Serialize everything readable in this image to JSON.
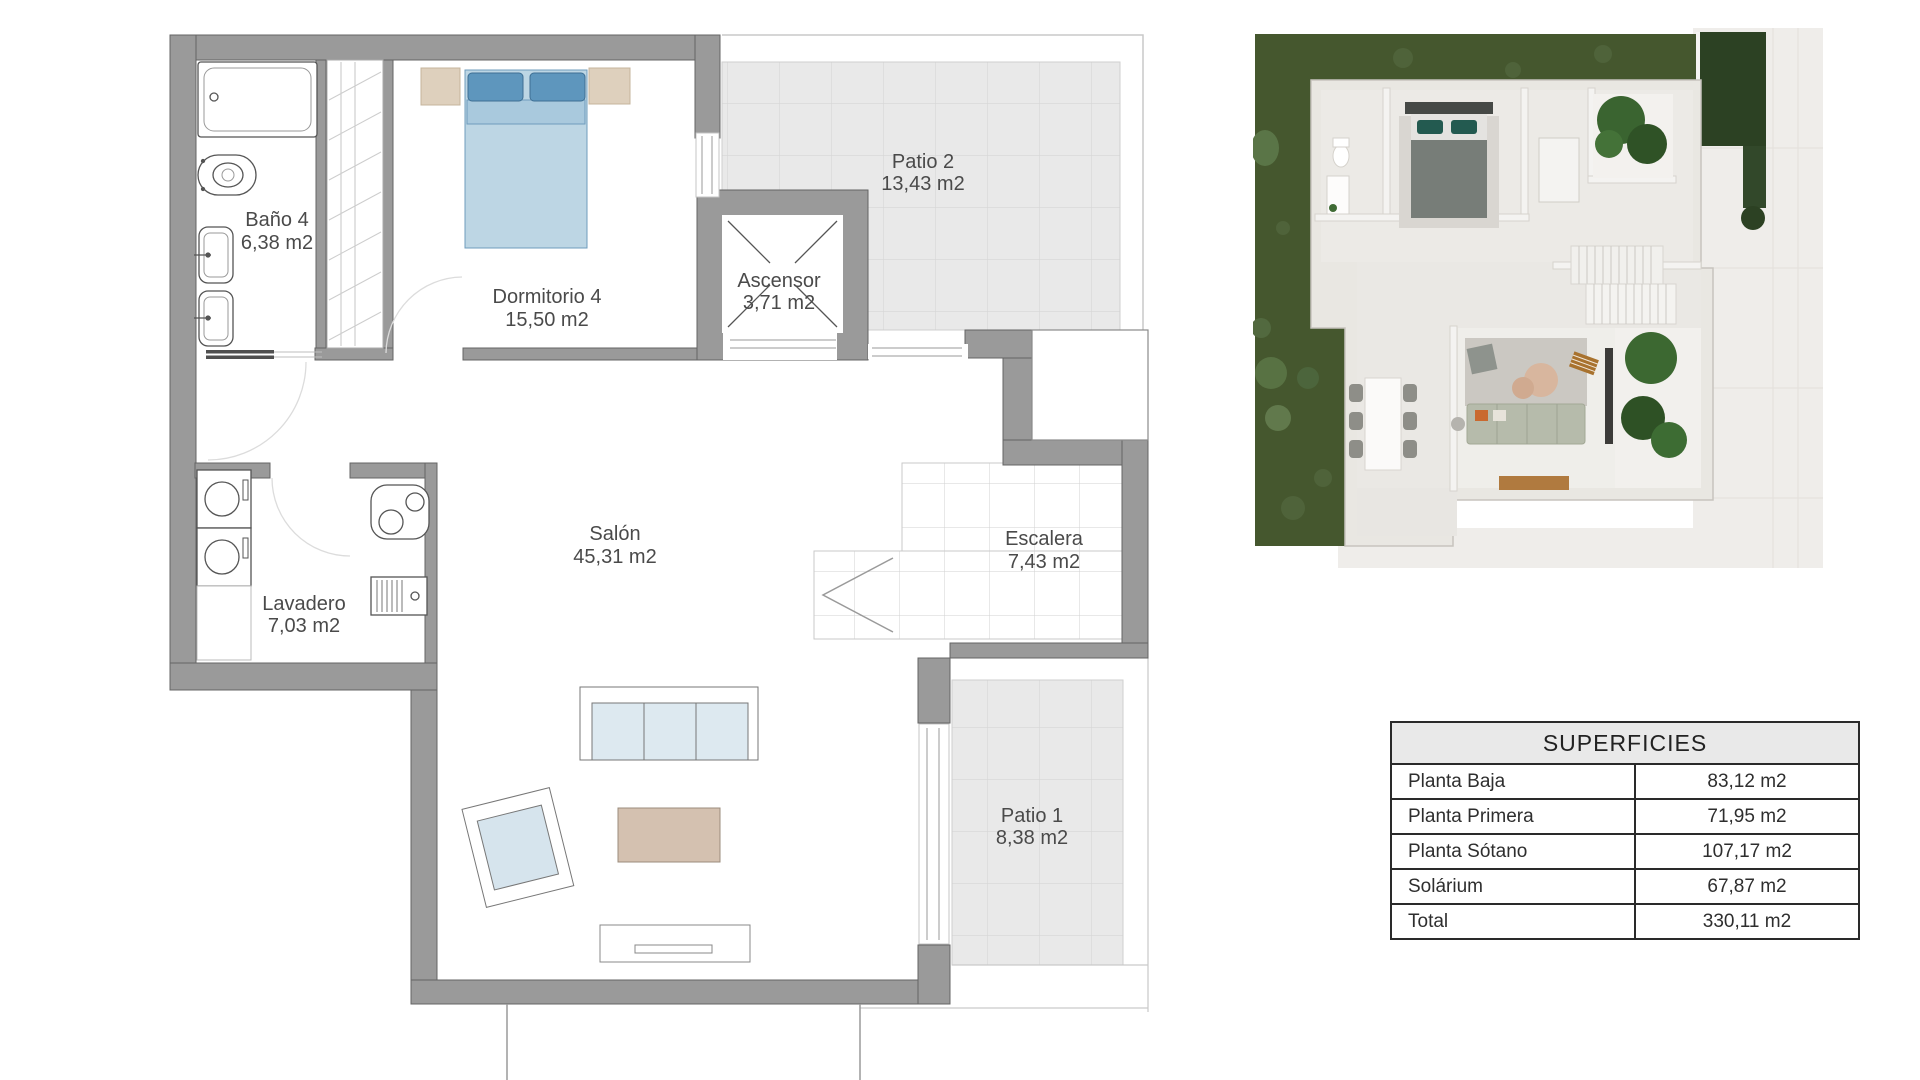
{
  "floor_plan": {
    "rooms": {
      "bano": {
        "name": "Baño 4",
        "area": "6,38 m2"
      },
      "dormitorio": {
        "name": "Dormitorio 4",
        "area": "15,50 m2"
      },
      "ascensor": {
        "name": "Ascensor",
        "area": "3,71 m2"
      },
      "patio2": {
        "name": "Patio 2",
        "area": "13,43 m2"
      },
      "salon": {
        "name": "Salón",
        "area": "45,31 m2"
      },
      "escalera": {
        "name": "Escalera",
        "area": "7,43 m2"
      },
      "lavadero": {
        "name": "Lavadero",
        "area": "7,03 m2"
      },
      "patio1": {
        "name": "Patio 1",
        "area": "8,38 m2"
      }
    },
    "colors": {
      "wall": "#9a9a9a",
      "tile": "#e9e9e9",
      "label_text": "#4a4a4a",
      "bed_pillow": "#5e96bd",
      "bed_body": "#bdd6e4",
      "coffee_table": "#d4c1b0",
      "nightstand": "#ded0bd"
    }
  },
  "render_3d": {
    "colors": {
      "grass": "#45572e",
      "hedge": "#2c4123",
      "house_wall": "#e9e7e2",
      "floor": "#eceae6",
      "plant": "#3a6430",
      "wood": "#a8722e"
    }
  },
  "surfaces_table": {
    "title": "SUPERFICIES",
    "rows": [
      {
        "label": "Planta Baja",
        "value": "83,12 m2"
      },
      {
        "label": "Planta Primera",
        "value": "71,95 m2"
      },
      {
        "label": "Planta Sótano",
        "value": "107,17 m2"
      },
      {
        "label": "Solárium",
        "value": "67,87 m2"
      },
      {
        "label": "Total",
        "value": "330,11 m2"
      }
    ]
  }
}
